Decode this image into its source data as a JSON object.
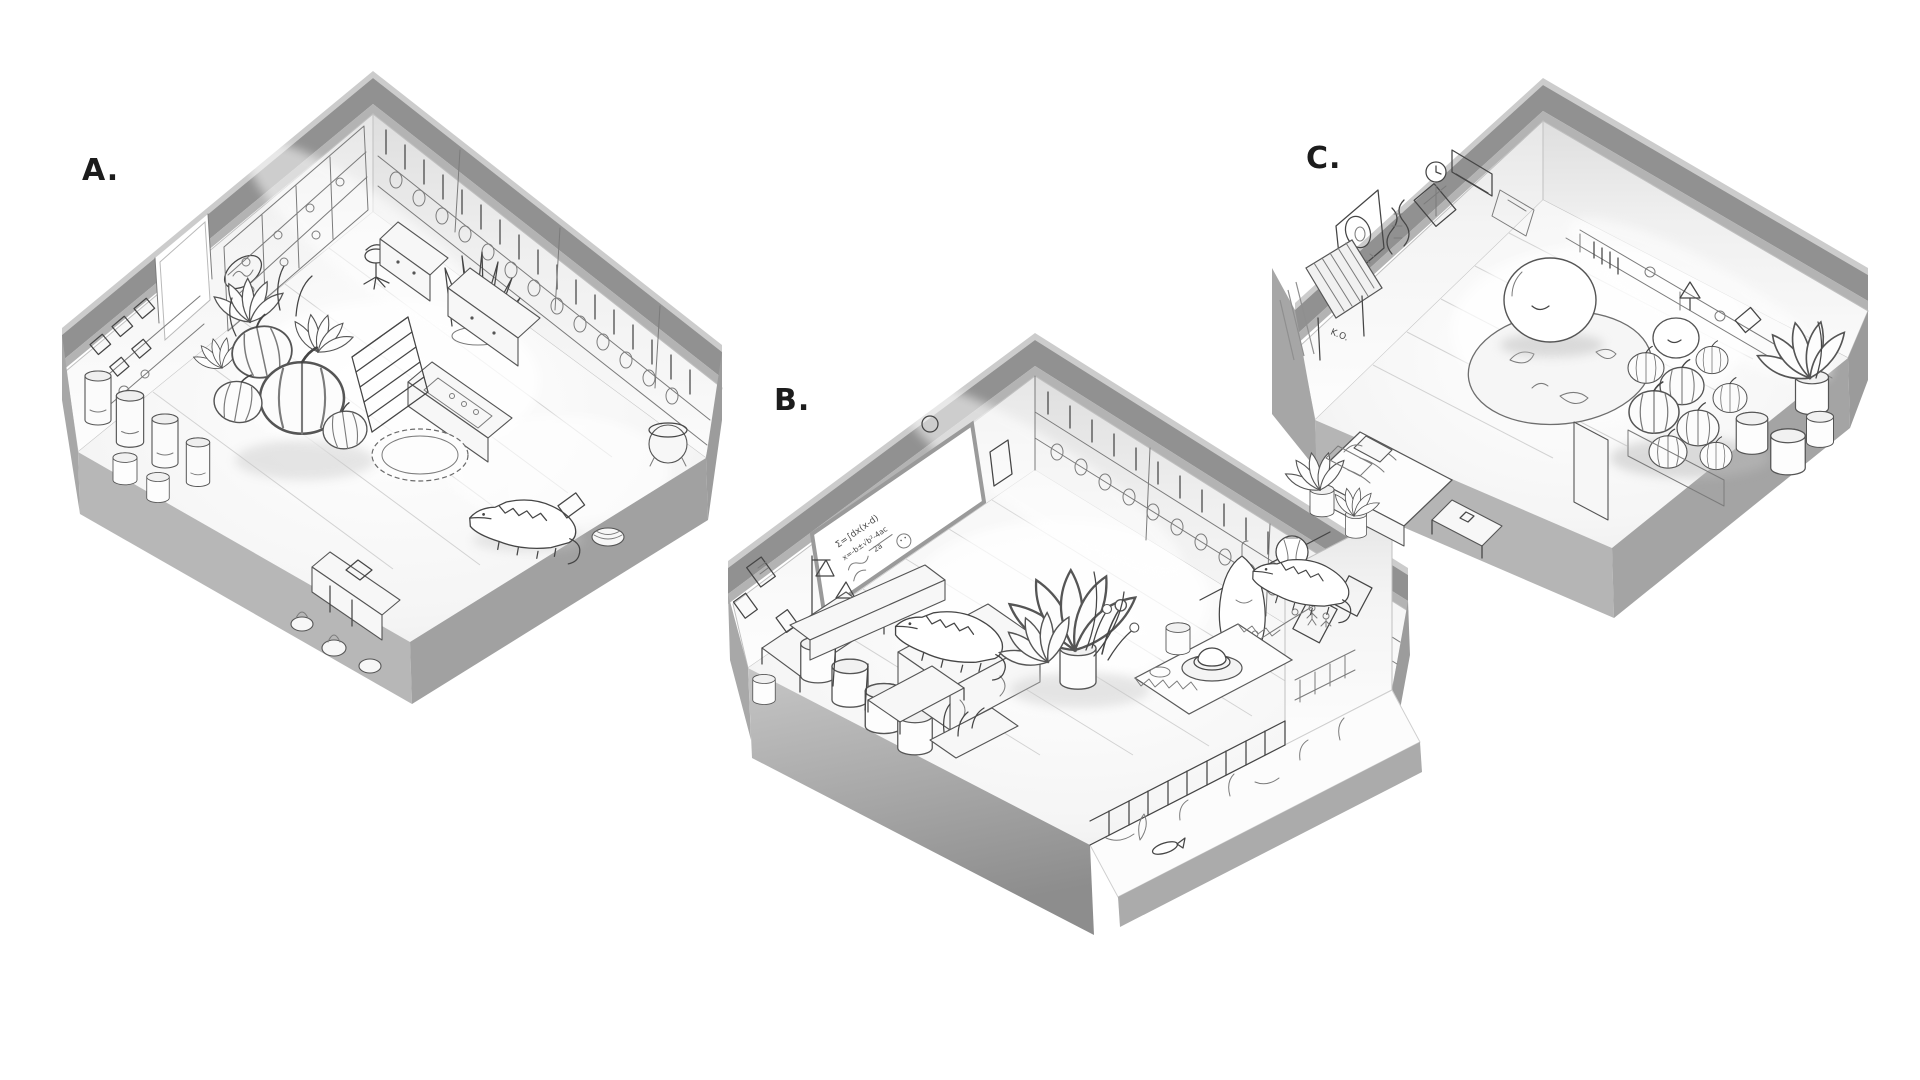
{
  "rooms": [
    {
      "id": "A",
      "label": "A.",
      "name": "shop-interior-sketch",
      "description": "Cutaway isometric pencil sketch of a cluttered apothecary-style shop: wall shelves of jars and books, tall glass canisters, large striped gourds and leafy plants, a staircase, counters and cabinets, a lace rug, floor pots, a cauldron and a small crocodile on the floorboards."
    },
    {
      "id": "B",
      "label": "B.",
      "name": "classroom-lab-sketch",
      "description": "Cutaway isometric pencil sketch of a classroom lab: whiteboard covered in equations, a shelf wall packed with jars, a lab bench with retort stand and flasks, cylinder stools, a long table with a crocodile lying on it, a large leafy plant, a cloth-covered table with a hat, posters, a hanging cloak, a paper lantern and a fenced pond strip with plants and a fish."
    },
    {
      "id": "C",
      "label": "C.",
      "name": "den-bedroom-sketch",
      "description": "Cutaway isometric pencil sketch of a cozy den: wall clock, posters with an egg doodle and a DNA helix, a striped awning, a round rug with a large sleeping blob creature plus a smaller blob, a pile of striped pumpkins, a long desk with a lamp, baskets, a bed, potted plants and a crocodile."
    }
  ],
  "annotations": {
    "whiteboard_line1": "Σ=∫dx(x-d)",
    "whiteboard_line2": "x=-b±√b²-4ac",
    "whiteboard_line3": "2a",
    "wall_tag": "K.O."
  },
  "palette": {
    "background": "#ffffff",
    "wall_band": "#919191",
    "band_edge_light": "#cccccc",
    "band_edge_inner": "#b3b3b3",
    "base_front_left": "#b7b7b7",
    "base_front_right": "#a1a1a1",
    "base_dark": "#8d8d8d",
    "sketch_line": "#454545",
    "interior_white": "#f7f7f7"
  }
}
